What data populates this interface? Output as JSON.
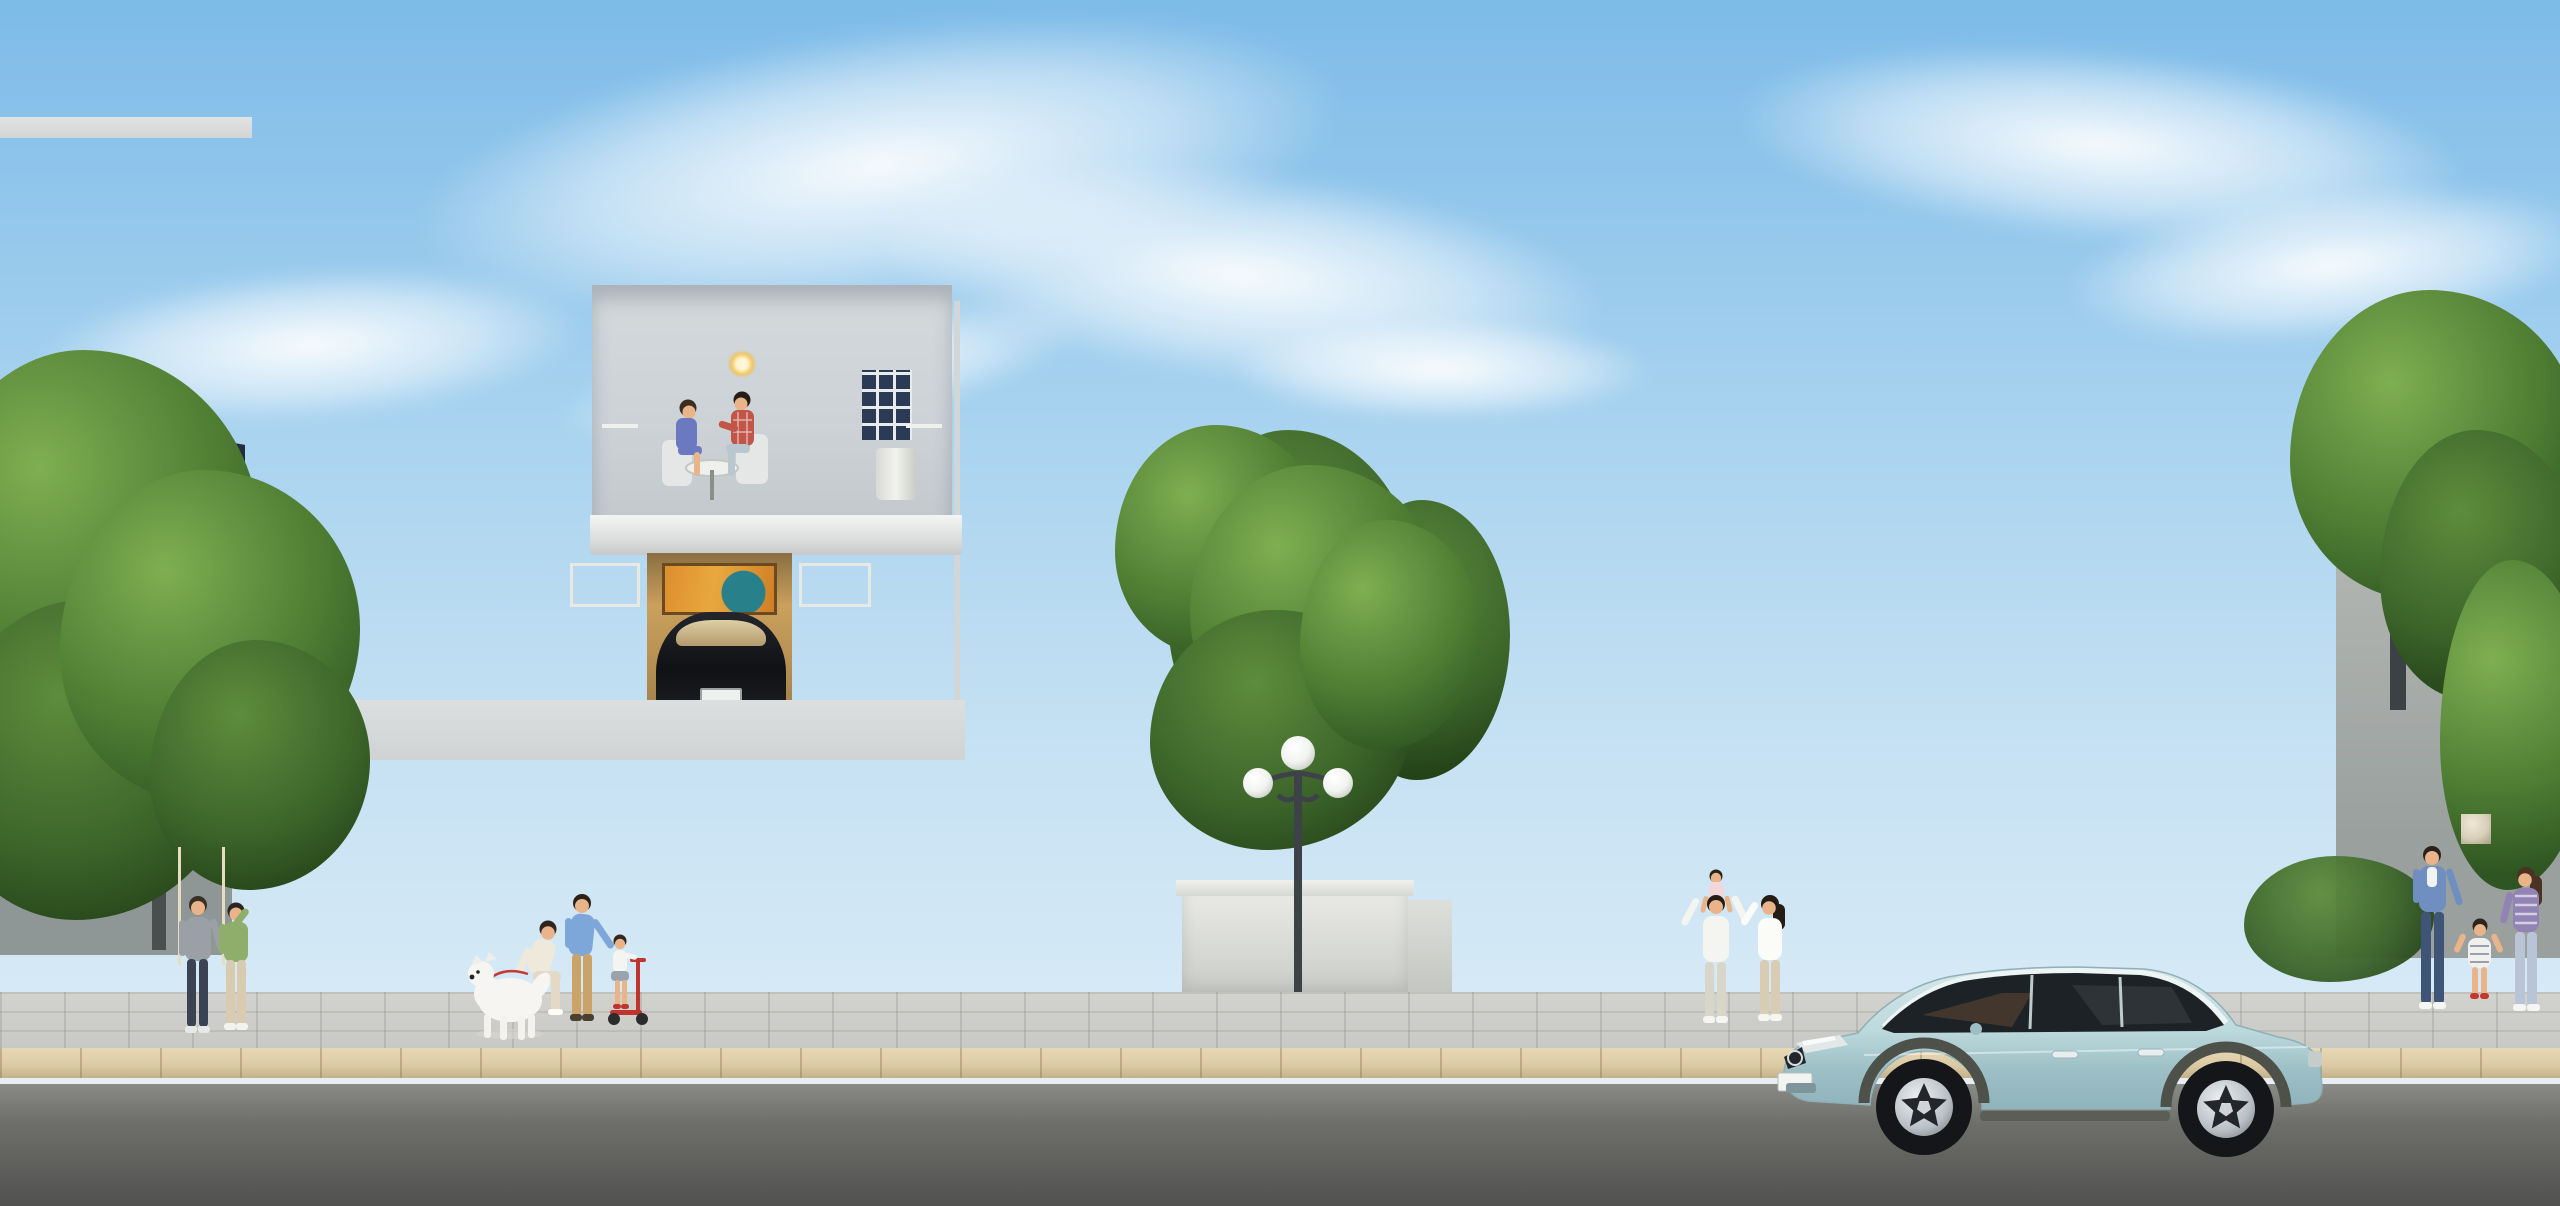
{
  "scene": {
    "type": "architectural-rendering",
    "title": "Daytime street view of twin neoclassical villas with navy hipped roofs, families on the sidewalk and a light-blue SUV",
    "sky": "blue sky with wispy white clouds"
  },
  "palette": {
    "sky_top": "#7dbbe8",
    "sky_mid": "#a7d2ef",
    "sky_horizon": "#e3f0f8",
    "roof_light": "#3d4a66",
    "roof_dark": "#1a2133",
    "facade": "#e6e8e8",
    "facade_shade": "#ccd2d6",
    "trim_white": "#f3f4f2",
    "window_frame": "#26292d",
    "glass_warm": "#e6bd6d",
    "glass_warm_deep": "#a06f2c",
    "foliage_dark": "#2f5522",
    "foliage_mid": "#4e7d33",
    "foliage_light": "#7fae52",
    "hedge_yellow": "#aabc49",
    "flower_yellow": "#ecc93f",
    "fence_iron": "#2c3034",
    "stone": "#d8d9d5",
    "stone_dark": "#b9bbb6",
    "sidewalk": "#c8c8c4",
    "curb": "#dbc9a4",
    "road": "#636360",
    "lane": "#e8edf0",
    "car_body": "#bcd9dc",
    "wood": "#c9ae7d",
    "skin": "#e9b489",
    "interior_warm": "#caa05c",
    "painting_orange": "#dd8f2d",
    "painting_teal": "#27808a"
  },
  "buildings": {
    "left_villa": {
      "label": "Left twin villa: two storeys, navy hipped tile roof, stucco facade, arched two-storey tower window on its left, balcony with black iron railing, three narrow upper windows, open garage with parked dark car and abstract painting, white folding doors, two arched ground-floor windows, tall warm-lit entry door, lantern sconces"
    },
    "right_villa": {
      "label": "Right twin villa: mirrored copy of the left villa, tower with arched window on its right, balcony with bonsai planters and chandelier glowing through the glass door, open entry gate below"
    },
    "left_neighbor": {
      "label": "Neighbouring villa partially hidden behind large tree at far left"
    },
    "right_neighbor": {
      "label": "Neighbouring villa with wooden pergola and pink bougainvillea at far right"
    }
  },
  "street": {
    "fence": "Low stone wall with dark iron railing and stone pillars in front of both villas",
    "gate_right": "Open double iron gate at the right villa",
    "lamp": {
      "label": "Classic three-globe street lamp in centre median",
      "globe_count": 3
    },
    "planter": "White rectangular planter with ornamental tree behind the lamp",
    "hedge": "Trimmed yellow-green hedge ring and white-flower shrubs around the median",
    "sidewalk": "Light paved sidewalk with dappled tree shadows",
    "road": {
      "label": "Asphalt road",
      "markings": "solid white edge line along curb and dashed white centre line"
    }
  },
  "vehicles": {
    "suv": {
      "label": "Light blue luxury SUV parked on the road facing left",
      "color_hex": "#bcd9dc",
      "windows": "dark tinted"
    },
    "garage_car": {
      "label": "Dark coupe parked inside the left villa garage"
    }
  },
  "people": {
    "groups": [
      {
        "id": "elderly-couple",
        "label": "Elderly couple standing at the left gate",
        "members": [
          "man in gray polo and dark trousers",
          "woman in green blouse and beige trousers"
        ]
      },
      {
        "id": "dog-group",
        "label": "Woman crouching with white fluffy dog on a red leash",
        "members": [
          "woman in cream outfit",
          "white samoyed dog"
        ]
      },
      {
        "id": "scooter-group",
        "label": "Father helping daughter ride a red kick scooter",
        "members": [
          "man in blue shirt and khaki trousers",
          "girl in white top and gray skirt"
        ]
      },
      {
        "id": "balcony-couple",
        "label": "Couple seated at a round table on the left villa balcony",
        "members": [
          "woman in blue dress",
          "man in red plaid shirt"
        ]
      },
      {
        "id": "gate-family",
        "label": "Parents leaving the right gate with daughter on father's shoulders",
        "members": [
          "man in white shirt",
          "small girl carried on shoulders",
          "woman in white top and beige trousers"
        ]
      },
      {
        "id": "corner-family",
        "label": "Family of three walking past the corner pillar at far right",
        "members": [
          "man in blue shirt and jeans",
          "girl in striped dress",
          "woman in striped top and light jeans"
        ]
      }
    ]
  }
}
